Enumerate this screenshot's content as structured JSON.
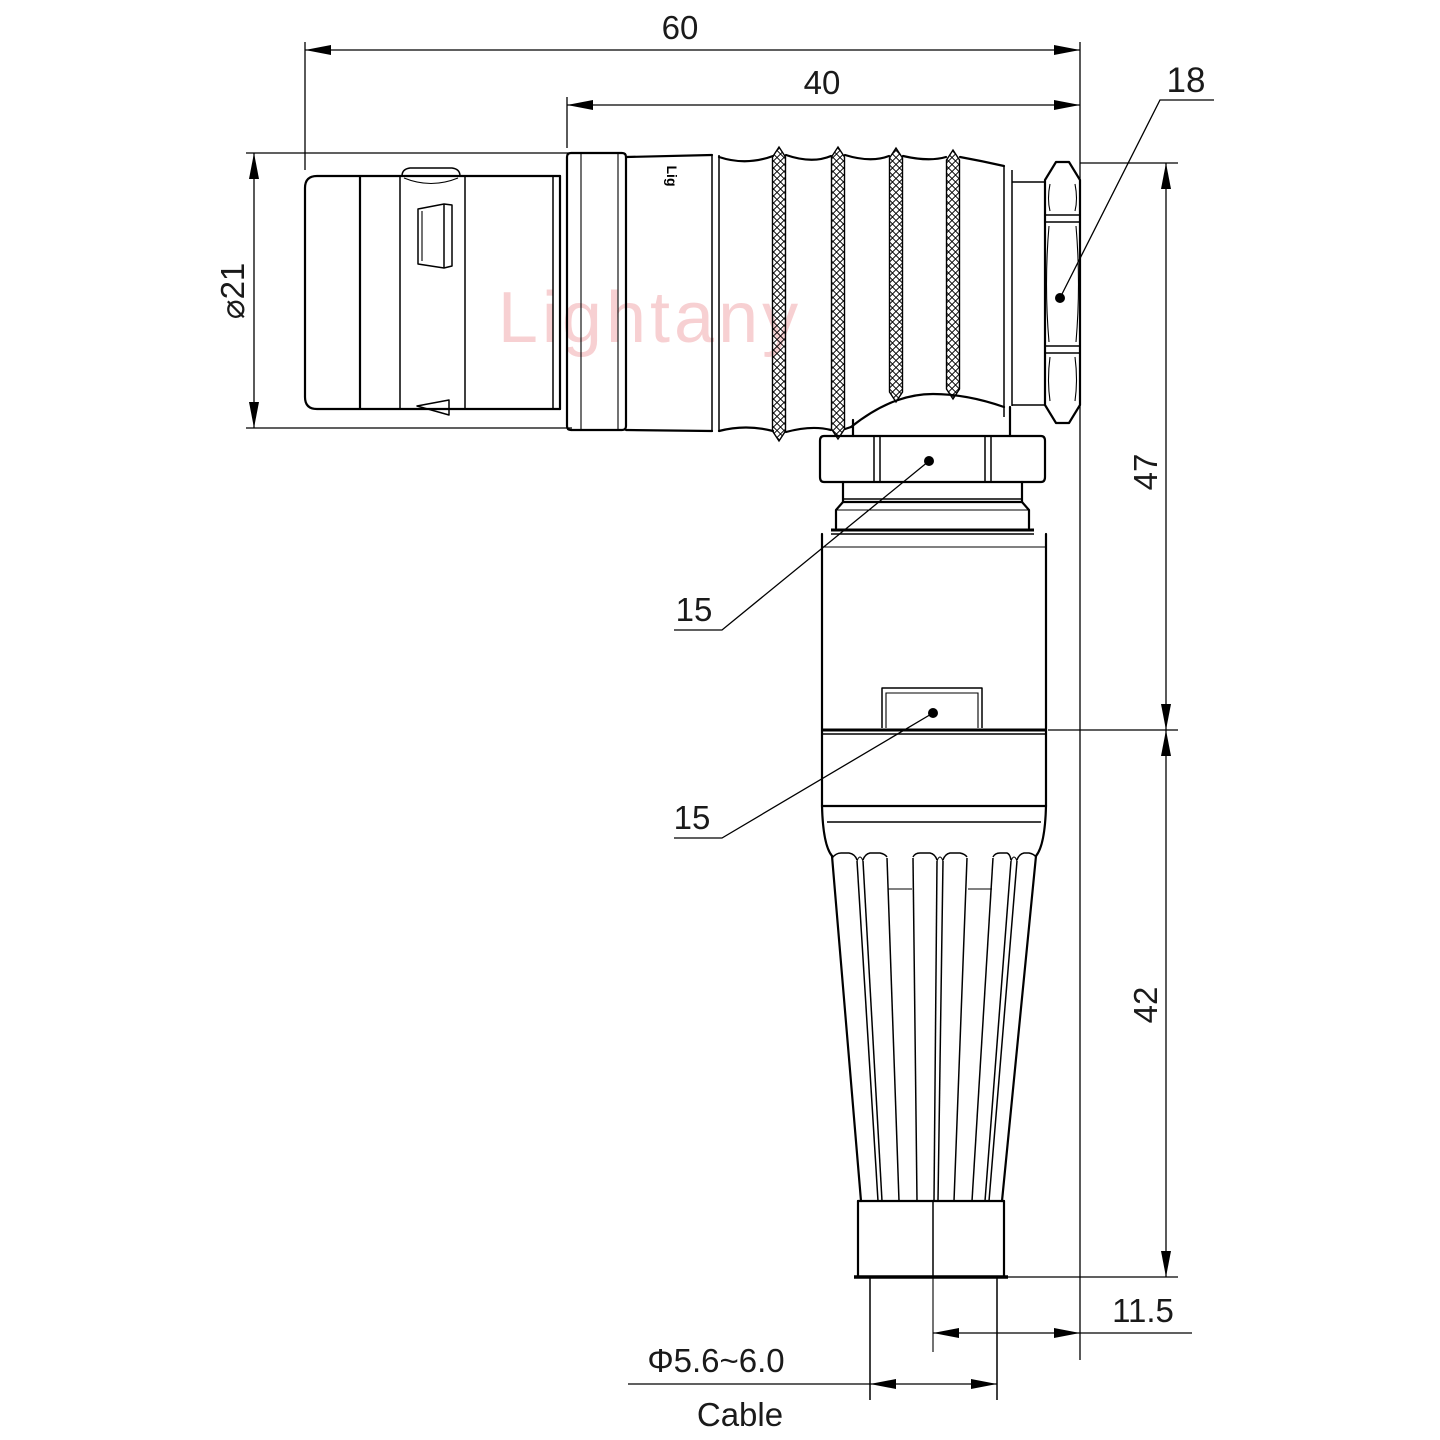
{
  "drawing": {
    "watermark": "Lightany",
    "part_marking": "Lig",
    "colors": {
      "line": "#000000",
      "watermark": "#F1A3A6",
      "background": "#FFFFFF"
    },
    "dimensions": {
      "overall_length": "60",
      "body_length": "40",
      "front_diameter": "⌀21",
      "nut_across_flats": "18",
      "height_upper": "47",
      "height_lower": "42",
      "axis_offset": "11.5",
      "gland_hex_upper": "15",
      "gland_hex_lower": "15",
      "cable_diameter": "Φ5.6~6.0",
      "cable_label": "Cable"
    }
  }
}
